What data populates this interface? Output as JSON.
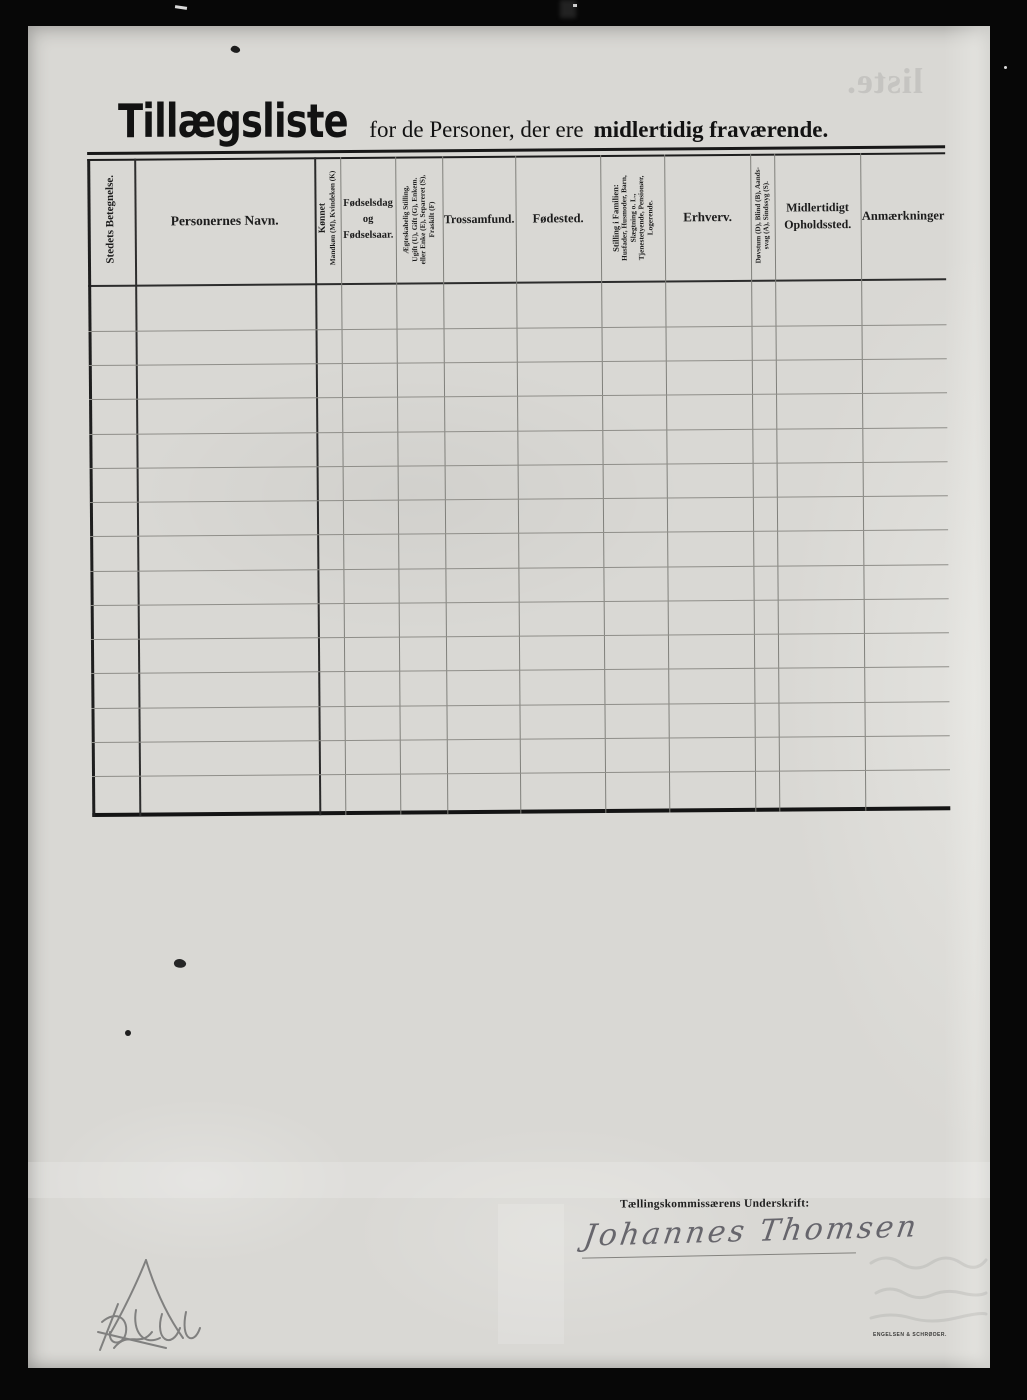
{
  "title": {
    "main": "Tillægsliste",
    "rest": "for de Personer, der ere",
    "emphasis": "midlertidig fraværende."
  },
  "table": {
    "row_count": 15,
    "columns": [
      {
        "label": "Stedets Betegnelse.",
        "orientation": "vertical"
      },
      {
        "label": "Personernes Navn.",
        "orientation": "horizontal"
      },
      {
        "label": "Kønnet",
        "sublabel": "Mandkøn (M), Kvindekøn (K)",
        "orientation": "vertical"
      },
      {
        "label": "Fødselsdag\nog\nFødselsaar.",
        "orientation": "horizontal"
      },
      {
        "label": "Ægteskabelig Stilling,\nUgift (U), Gift (G), Enkem.\neller Enke (E), Separeret (S),\nFraskilt (F)",
        "orientation": "vertical"
      },
      {
        "label": "Trossamfund.",
        "orientation": "horizontal"
      },
      {
        "label": "Fødested.",
        "orientation": "horizontal"
      },
      {
        "label": "Stilling i Familien:",
        "sublabel": "Husfader, Husmoder, Barn,\nSlægtning o. L.,\nTjenestetyende, Pensionær,\nLogerende.",
        "orientation": "vertical"
      },
      {
        "label": "Erhverv.",
        "orientation": "horizontal"
      },
      {
        "label": "Døvstum (D), Blind (B), Aands-\nsvag (A), Sindssyg (S).",
        "orientation": "vertical"
      },
      {
        "label": "Midlertidigt\nOpholdssted.",
        "orientation": "horizontal"
      },
      {
        "label": "Anmærkninger",
        "orientation": "horizontal"
      }
    ]
  },
  "signature": {
    "label": "Tællingskommissærens Underskrift:",
    "handwritten_name": "Johannes Thomsen"
  },
  "imprint": "ENGELSEN & SCHRØDER.",
  "bleedthrough": {
    "mirrored_text": "liste."
  },
  "colors": {
    "background": "#070707",
    "paper": "#d9d8d4",
    "ink": "#1b1b1b",
    "rule_dark": "#1e1e1e",
    "rule_light": "#80807b",
    "pencil": "#6b6b6b",
    "signature_ink": "#53525a"
  }
}
